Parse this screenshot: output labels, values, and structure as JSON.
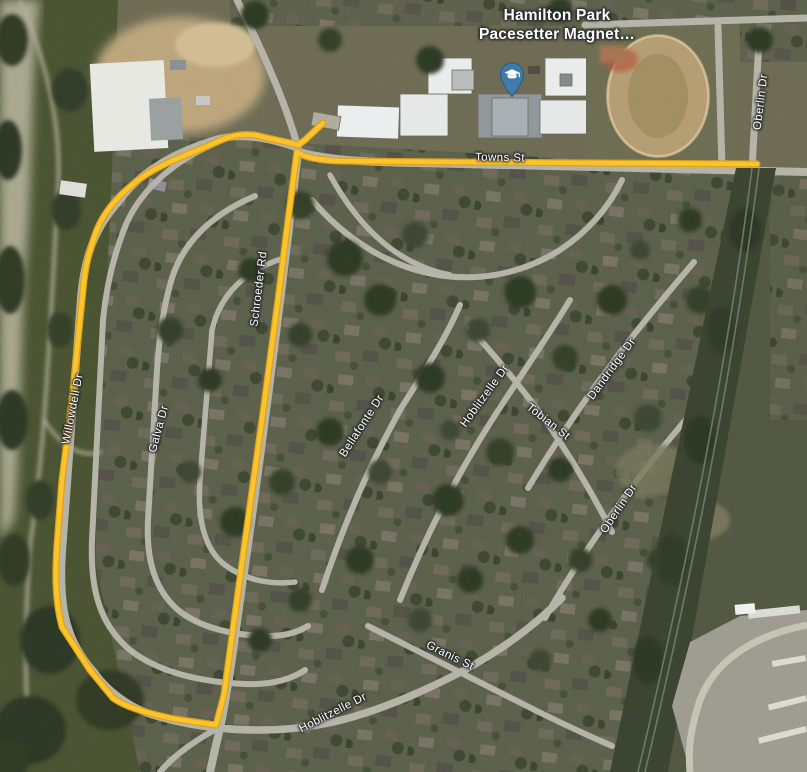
{
  "map": {
    "view": "satellite",
    "poi": {
      "name_line1": "Hamilton Park",
      "name_line2": "Pacesetter Magnet…",
      "marker_icon": "graduation-cap-marker",
      "marker_color": "#3e7ba8"
    },
    "route": {
      "color": "#fcc42c",
      "casing_color": "#dca31a"
    },
    "road_labels": [
      {
        "text": "Towns St"
      },
      {
        "text": "Oberlin Dr"
      },
      {
        "text": "Schroeder Rd"
      },
      {
        "text": "Willowdell Dr"
      },
      {
        "text": "Galva Dr"
      },
      {
        "text": "Bellafonte Dr"
      },
      {
        "text": "Hoblitzelle Dr"
      },
      {
        "text": "Tobian St"
      },
      {
        "text": "Dandridge Dr"
      },
      {
        "text": "Oberlin Dr"
      },
      {
        "text": "Granis St"
      },
      {
        "text": "Hoblitzelle Dr"
      }
    ]
  }
}
